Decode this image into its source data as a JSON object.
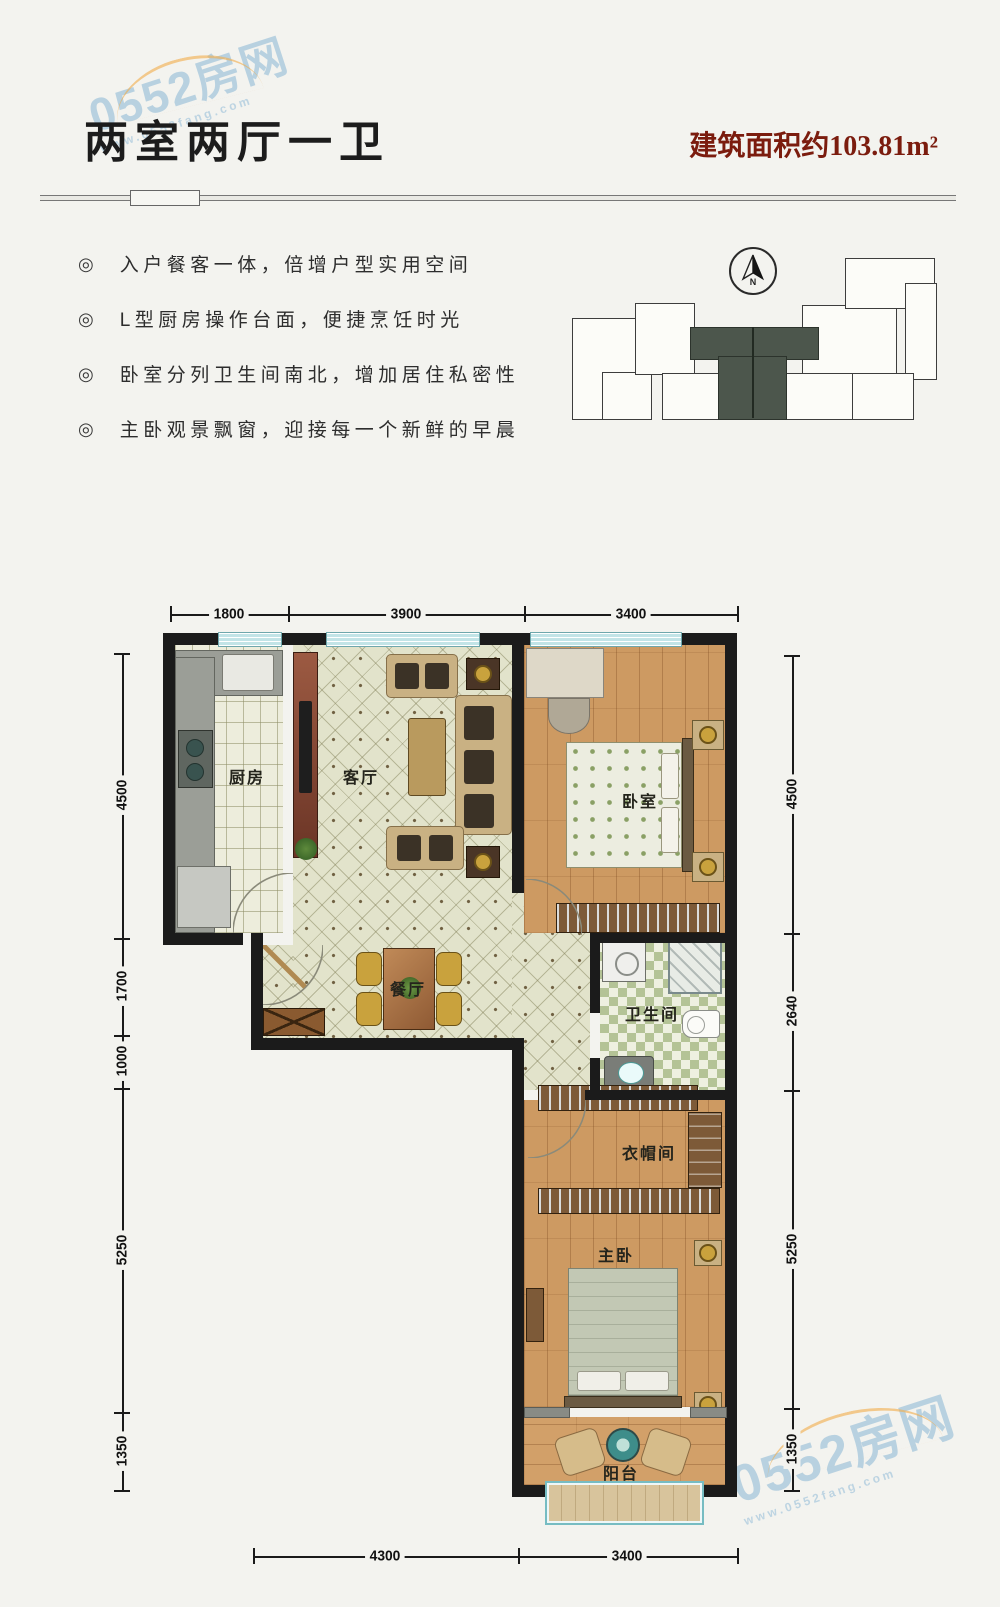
{
  "header": {
    "title": "两室两厅一卫",
    "area": "建筑面积约103.81m²"
  },
  "bullet_icon": "◎",
  "features": [
    "入户餐客一体，倍增户型实用空间",
    "L型厨房操作台面，便捷烹饪时光",
    "卧室分列卫生间南北，增加居住私密性",
    "主卧观景飘窗，迎接每一个新鲜的早晨"
  ],
  "compass": {
    "label": "N"
  },
  "rooms": {
    "kitchen": "厨房",
    "living": "客厅",
    "bedroom": "卧室",
    "dining": "餐厅",
    "bathroom": "卫生间",
    "cloakroom": "衣帽间",
    "master": "主卧",
    "balcony": "阳台"
  },
  "dimensions": {
    "top": [
      "1800",
      "3900",
      "3400"
    ],
    "left": [
      "4500",
      "1700",
      "1000",
      "5250",
      "1350"
    ],
    "right": [
      "4500",
      "2640",
      "5250",
      "1350"
    ],
    "bottom": [
      "4300",
      "3400"
    ]
  },
  "watermark": {
    "brand": "0552房网",
    "url": "www.0552fang.com"
  },
  "colors": {
    "accent_red": "#7b1c0e",
    "wall": "#1b1b1b",
    "highlighted_unit": "#4c564c",
    "window": "#c2e4e7",
    "watermark_blue": "#7dafd2"
  }
}
